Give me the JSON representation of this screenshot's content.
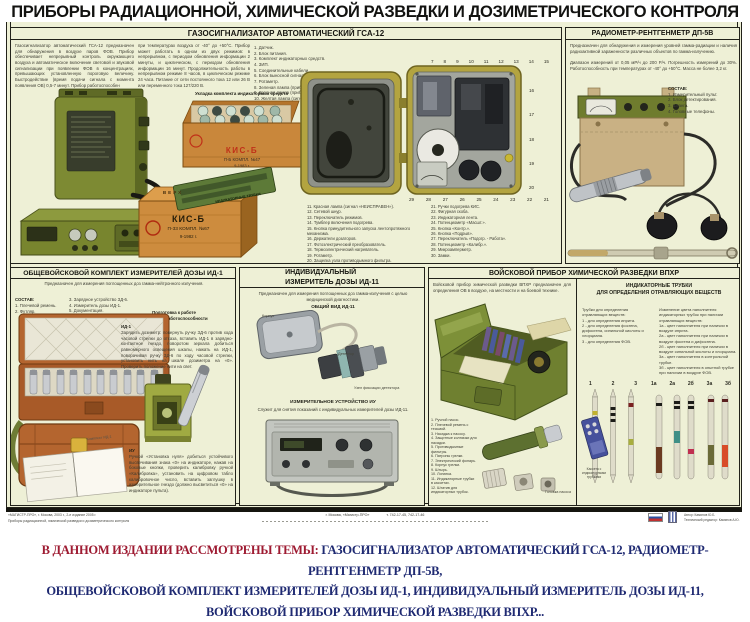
{
  "poster": {
    "title": "ПРИБОРЫ РАДИАЦИОННОЙ, ХИМИЧЕСКОЙ РАЗВЕДКИ И ДОЗИМЕТРИЧЕСКОГО КОНТРОЛЯ",
    "bg_color": "#eef0d6",
    "frame_color": "#22221a"
  },
  "gsa12": {
    "header": "ГАЗОСИГНАЛИЗАТОР АВТОМАТИЧЕСКИЙ ГСА-12",
    "desc_left": "Газосигнализатор автоматический ГСА-12 предназначен для обнаружения в воздухе паров ФОВ. Прибор обеспечивает непрерывный контроль окружающего воздуха и автоматическое включение световой и звуковой сигнализации при появлении ФОВ в концентрациях, превышающих установленную пороговую величину. Быстродействие (время подачи сигнала с момента появления ОВ) 0,5-7 минут. Прибор работоспособен",
    "desc_right": "при температурах воздуха от -40° до +50°С. Прибор может работать в одном из двух режимов: в непрерывном, с периодом обновления информации 2 минуты, и циклическом, с периодом обновления информации 16 минут. Продолжительность работы в непрерывном режиме 8 часов, в циклическом режиме 24 часа. Питание от сети постоянного тока 12 или 26 В или переменного тока 127/220 В.",
    "components": [
      "1. Датчик.",
      "2. Блок питания.",
      "3. Комплект индикаторных средств.",
      "4. ЗИП.",
      "5. Соединительные кабели.",
      "6. Блок выносной сигнализации.",
      "7. Ротаметр.",
      "8. Зеленая лампа (прибор включен).",
      "9. Красная лампа (прибор прогрет).",
      "10. Желтая лампа (сигнал «ОПАСНО»)."
    ],
    "kis_caption": "Укладка комплекта индикаторных средств",
    "package_label": "ИНДИКАТОРНЫЕ ТРУБКИ",
    "open_crate": {
      "brand": "КИС-Б",
      "line2": "П-Б   КОМПЛ. №47",
      "line3": "9-1983 г."
    },
    "closed_crate": {
      "top": "ВЕРХ",
      "brand": "КИС-Б",
      "line2": "П-33   КОМПЛ. №67",
      "line3": "9-1982 г."
    },
    "top_callouts": [
      "7",
      "8",
      "9",
      "10",
      "11",
      "12",
      "13",
      "14",
      "15"
    ],
    "right_callouts": [
      "16",
      "17",
      "18",
      "19",
      "20"
    ],
    "bottom_callouts": [
      "29",
      "28",
      "27",
      "26",
      "25",
      "24",
      "23",
      "22",
      "21"
    ],
    "callouts_left": [
      "11. Красная лампа (сигнал «НЕИСПРАВЕН»).",
      "12. Сетевой шнур.",
      "13. Переключатель режимов.",
      "14. Тумблер включения подогрева.",
      "15. Кнопка принудительного запуска лентопротяжного механизма.",
      "16. Держатели дозаторов.",
      "17. Фотоэлектрический преобразователь.",
      "18. Термоэлектрический нагреватель.",
      "19. Ротаметр.",
      "20. Защелка узла противодымного фильтра."
    ],
    "callouts_right": [
      "21. Ручки подогрева КИС.",
      "22. Фигурная скоба.",
      "23. Индикаторная лента.",
      "24. Потенциометр «Масшт.».",
      "25. Кнопка «Контр.».",
      "26. Кнопка «Подрыв».",
      "27. Переключатель «Подогр. - Работа».",
      "28. Потенциометр «Калибр.».",
      "29. Микроамперметр.",
      "30. Замки."
    ]
  },
  "dp5v": {
    "header": "РАДИОМЕТР-РЕНТГЕНМЕТР ДП-5В",
    "desc1": "Предназначен для обнаружения и измерения уровней гамма-радиации и наличия радиоактивной зараженности различных объектов по гамма-излучению.",
    "desc2": "Диапазон измерений от 0,05 мР/ч до 200 Р/ч. Погрешность измерений до 30%. Работоспособность при температурах от -40° до +50°С. Масса не более 3,2 кг.",
    "sostav_title": "СОСТАВ:",
    "sostav": [
      "1. Измерительный пульт.",
      "2. Блок детектирования.",
      "3. Штанга.",
      "4. Головные телефоны."
    ]
  },
  "id1": {
    "header": "ОБЩЕВОЙСКОВОЙ КОМПЛЕКТ ИЗМЕРИТЕЛЕЙ ДОЗЫ ИД-1",
    "purpose": "Предназначен для измерения поглощенных доз гамма-нейтронного излучения.",
    "sostav_title": "СОСТАВ:",
    "sostav_col1": [
      "1. Плечевой ремень.",
      "2. Футляр."
    ],
    "sostav_col2": [
      "3. Зарядное устройство ЗД-6.",
      "4. Измеритель дозы ИД-1.",
      "5. Документация."
    ],
    "prep_title": "Подготовка к работе\nи проверка работоспособности",
    "id1_label": "ИД-1",
    "id1_text": "Зарядить дозиметр: повернуть ручку ЗД-6 против хода часовой стрелки до отказа, вставить ИД-1 в зарядно-контактное гнездо, поворотом зеркала добиться равномерного освещения шкалы, нажать на ИД-1, поворачивая ручку ЗД-6 по ходу часовой стрелки, установить нить на шкале дозиметра на «0». Проверить положение нити на свет.",
    "iu_label": "ИУ",
    "iu_text": "Ручкой «Установка нуля» добиться устойчивого высвечивания знака «0» на индикаторе, нажав на боковые кнопки, проверить калибровку ручкой «Калибровка», установить на цифровом табло калибровочное число, вставить заглушку в измерительное гнездо (должно высветиться «0» на индикаторе пульта).",
    "booklet_label": "Комплект ИД-1"
  },
  "id11": {
    "header": "ИНДИВИДУАЛЬНЫЙ\nИЗМЕРИТЕЛЬ ДОЗЫ ИД-11",
    "purpose": "Предназначен для измерения поглощенных доз гамма-излучения с целью медицинской диагностики.",
    "view_title": "ОБЩИЙ ВИД ИД-11",
    "label_korpus": "Корпус",
    "label_detektor": "Детектор",
    "label_uzel": "Узел фиксации детектора",
    "iu_title": "ИЗМЕРИТЕЛЬНОЕ УСТРОЙСТВО ИУ",
    "iu_purpose": "Служит для снятия показаний с индивидуальных измерителей дозы ИД-11."
  },
  "vpkhr": {
    "header": "ВОЙСКОВОЙ ПРИБОР ХИМИЧЕСКОЙ РАЗВЕДКИ ВПХР",
    "intro": "Войсковой прибор химической разведки ВПХР предназначен для определения ОВ в воздухе, на местности и на боевой технике.",
    "components": [
      "1. Ручной насос.",
      "2. Плечевой ремень с тесьмой.",
      "3. Насадка к насосу.",
      "4. Защитные колпачки для насадки.",
      "5. Противодымные фильтры.",
      "6. Патроны грелки.",
      "7. Электрический фонарь.",
      "8. Корпус грелки.",
      "9. Штырь.",
      "10. Лопатка.",
      "11. Индикаторные трубки в кассетах.",
      "12. Штатив для индикаторных трубок."
    ],
    "pump_label": "Головка насоса"
  },
  "tubes": {
    "header": "ИНДИКАТОРНЫЕ ТРУБКИ\nДЛЯ ОПРЕДЕЛЕНИЯ ОТРАВЛЯЮЩИХ ВЕЩЕСТВ",
    "col1_intro": "Трубки для определения отравляющих веществ:",
    "col1_items": [
      "1 - для определения иприта.",
      "2 - для определения фосгена, дифосгена, синильной кислоты и хлорциана.",
      "3 - для определения ФОВ."
    ],
    "col2_intro": "Изменение цвета наполнителя индикаторных трубок при наличии отравляющих веществ:",
    "col2_items": [
      "1а - цвет наполнителя при наличии в воздухе иприта.",
      "2а - цвет наполнителя при наличии в воздухе фосгена и дифосгена.",
      "2б - цвет наполнителя при наличии в воздухе синильной кислоты и хлорциана.",
      "3а - цвет наполнителя в контрольной трубке.",
      "3б - цвет наполнителя в опытной трубке при наличии в воздухе ФОВ."
    ],
    "group1_labels": [
      "1",
      "2",
      "3"
    ],
    "group2_labels": [
      "1а",
      "2а",
      "2б",
      "3а",
      "3б"
    ],
    "cassette_label": "Кассета с индикаторными трубками"
  },
  "footer": {
    "left1": "«МАГИСТР-ПРО», г. Москва, 2003 г., 2-е издание 2005 г.",
    "left2": "Приборы радиационной, химической разведки и дозиметрического контроля",
    "center": "г. Москва, «Магистр-ПРО»",
    "phones": "т. 742-17-45, 742-17-46",
    "author": "Автор: Камянов Ю.Б.",
    "editor": "Технический редактор: Камянов А.Ю."
  },
  "caption": {
    "label": "В ДАННОМ ИЗДАНИИ РАССМОТРЕНЫ ТЕМЫ:",
    "line1": "ГАЗОСИГНАЛИЗАТОР АВТОМАТИЧЕСКИЙ ГСА-12, РАДИОМЕТР-РЕНТГЕНМЕТР ДП-5В,",
    "line2": "ОБЩЕВОЙСКОВОЙ КОМПЛЕКТ ИЗМЕРИТЕЛЕЙ ДОЗЫ ИД-1, ИНДИВИДУАЛЬНЫЙ ИЗМЕРИТЕЛЬ ДОЗЫ ИД-11,",
    "line3": "ВОЙСКОВОЙ ПРИБОР ХИМИЧЕСКОЙ РАЗВЕДКИ ВПХР...",
    "colors": {
      "label": "#9e1b32",
      "body": "#1f2a72"
    }
  }
}
